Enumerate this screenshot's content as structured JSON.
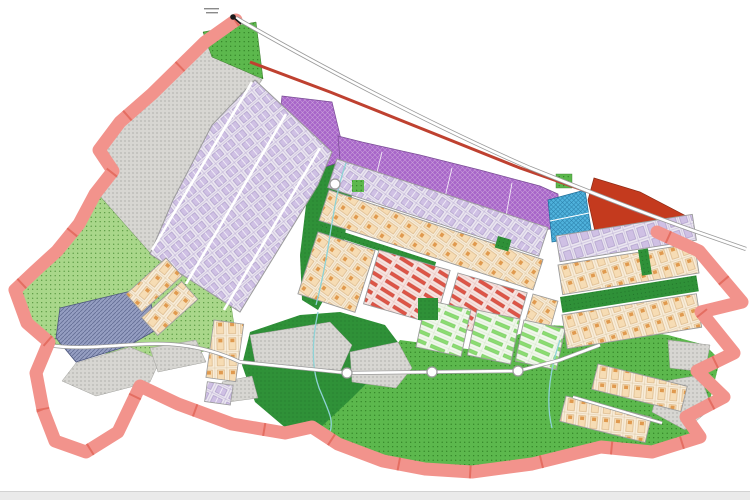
{
  "window": {
    "background": "#ffffff",
    "bottom_edge_color": "#eaeaea"
  },
  "map": {
    "boundary": {
      "color": "#f2938c",
      "tick_color": "#e2695c"
    },
    "roads": {
      "casing": "#9b9b9b",
      "fill": "#ffffff",
      "highway_stripe": "#bf4130"
    },
    "water": {
      "stream_color": "#8ed2d6"
    },
    "marker": {
      "color": "#1a1a1a",
      "label_mark_color": "#8a8a8a"
    },
    "zones": {
      "open_space_gray": {
        "color": "#d7d6d2",
        "dot": "#7e7e7a"
      },
      "agriculture_light_green": {
        "color": "#a9d78a",
        "dot": "#44882e"
      },
      "field_mid_green": {
        "color": "#5cb84d",
        "dot": "#27761c"
      },
      "park_dark_green": {
        "color": "#2f9138",
        "dot": "#1d6a26"
      },
      "commercial_purple": {
        "color": "#a765c8",
        "hatch": "#d0aade"
      },
      "utility_blue": {
        "color": "#4fb2dc",
        "hatch": "#1f6f9a"
      },
      "facility_blue_gray": {
        "color": "#959ec2",
        "line": "#667097"
      },
      "special_red": {
        "color": "#c43a1e"
      },
      "residential_lavender": {
        "plot": "#ebe6f1",
        "unit": "#cfc0e4",
        "outline": "#9d8cbe"
      },
      "residential_peach": {
        "plot": "#f9edd9",
        "unit": "#f6dcb4",
        "mark": "#e09a4f"
      },
      "rows_red": {
        "plot": "#f7e4e1",
        "bar": "#de5547"
      },
      "rows_green": {
        "plot": "#f1f8ec",
        "bar": "#8bdc72"
      }
    }
  }
}
